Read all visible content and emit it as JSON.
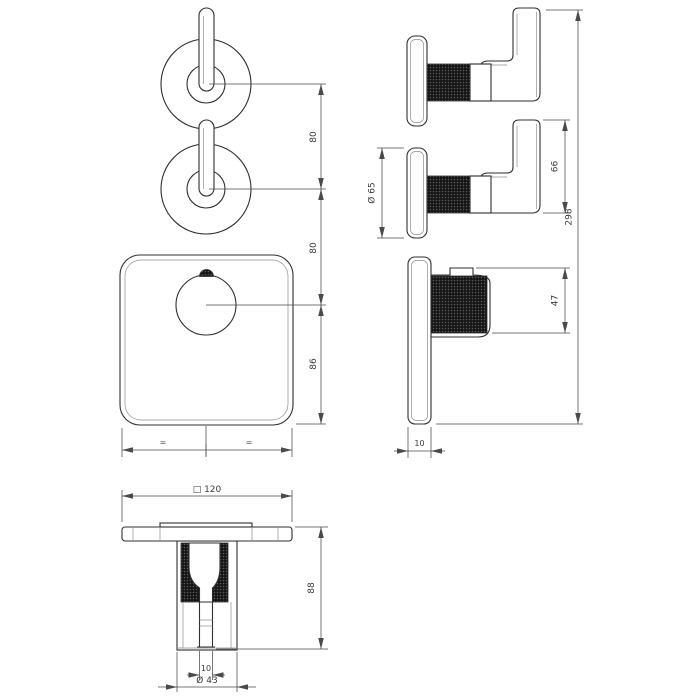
{
  "drawing": {
    "dimensions": {
      "spacing_top": "80",
      "spacing_mid": "80",
      "center_to_bottom": "86",
      "equal_left": "=",
      "equal_right": "=",
      "escutcheon_diameter": "Ø 65",
      "handle_height": "66",
      "overall_height": "298",
      "knob_projection": "47",
      "plate_thickness": "10",
      "plate_width": "□ 120",
      "knob_depth": "88",
      "stem_diameter": "10",
      "knob_diameter": "Ø 43"
    },
    "colors": {
      "line": "#2f2f2f",
      "dimension_line": "#4a4a4a",
      "knurl": "#141414",
      "background": "#ffffff"
    }
  }
}
